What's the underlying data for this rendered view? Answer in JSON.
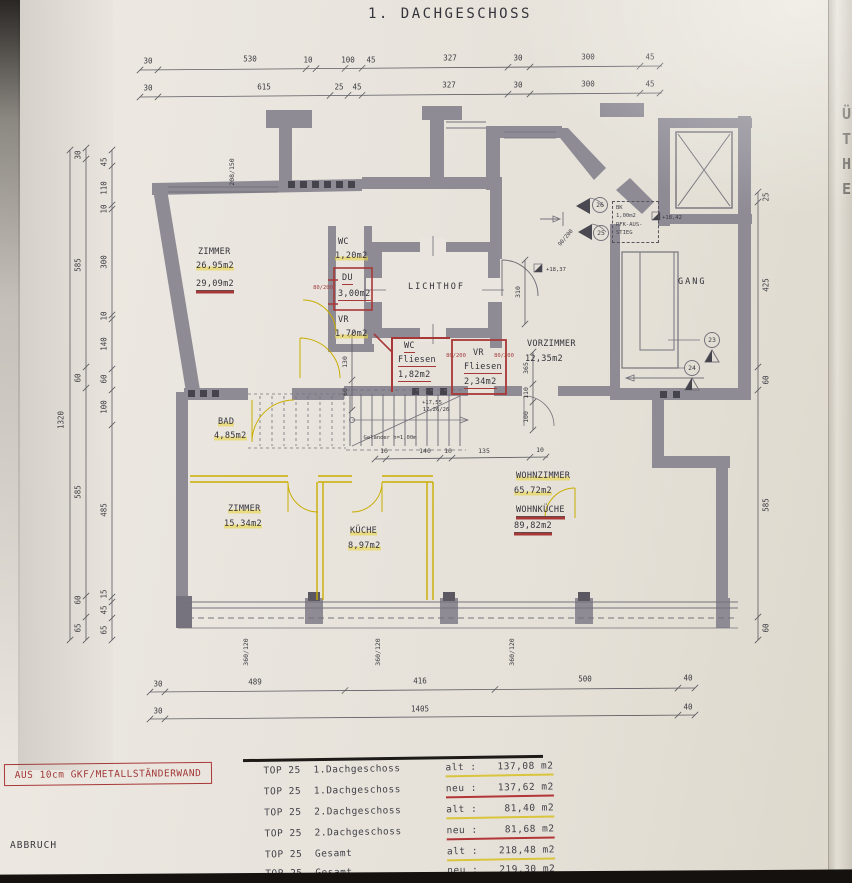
{
  "title": "1. DACHGESCHOSS",
  "edge_letters": [
    "Ü",
    "T",
    "H",
    "E"
  ],
  "legend": {
    "wall_note": "AUS 10cm GKF/METALLSTÄNDERWAND",
    "abbruch": "ABBRUCH"
  },
  "rooms": {
    "zimmer_nw": {
      "name": "ZIMMER",
      "area_old": "26,95m2",
      "area_new": "29,09m2"
    },
    "wc_nw": {
      "name": "WC",
      "area": "1,20m2"
    },
    "du": {
      "name": "DU",
      "area": "3,00m2"
    },
    "vr_nw": {
      "name": "VR",
      "area": "1,70m2"
    },
    "lichthof": {
      "name": "LICHTHOF"
    },
    "vorzimmer": {
      "name": "VORZIMMER",
      "area": "12,35m2"
    },
    "gang": {
      "name": "GANG"
    },
    "wc_mid": {
      "name": "WC",
      "finish": "Fliesen",
      "area": "1,82m2"
    },
    "vr_mid": {
      "name": "VR",
      "finish": "Fliesen",
      "area": "2,34m2"
    },
    "bad": {
      "name": "BAD",
      "area": "4,85m2"
    },
    "zimmer_sw": {
      "name": "ZIMMER",
      "area": "15,34m2"
    },
    "kueche": {
      "name": "KÜCHE",
      "area": "8,97m2"
    },
    "wohnzimmer": {
      "name": "WOHNZIMMER",
      "area": "65,72m2"
    },
    "wohnkueche": {
      "name": "WOHNKÜCHE",
      "area": "89,82m2"
    }
  },
  "annotations": {
    "gelaender": "Geländer h=1,00m",
    "stair_elev_1": "+17,55",
    "stair_elev_2": "17,26/26",
    "bk_box": [
      "BK",
      "1,00m2",
      "RFK-AUS-",
      "STIEG"
    ],
    "elev_1": "+18,42",
    "elev_2": "+18,37",
    "door_80_200": "80/200",
    "door_90_200": "90/200",
    "window_208_150": "208/150",
    "markers": {
      "m23": "23",
      "m24": "24",
      "m25": "25",
      "m26": "26"
    }
  },
  "dimensions": {
    "top1": [
      "30",
      "530",
      "10",
      "100",
      "45",
      "327",
      "30",
      "300",
      "45"
    ],
    "top2": [
      "30",
      "615",
      "25",
      "45",
      "327",
      "30",
      "300",
      "45"
    ],
    "left_total": [
      "1320"
    ],
    "left_outer": [
      "30",
      "585",
      "60",
      "585",
      "60",
      "65"
    ],
    "left_inner": [
      "45",
      "110",
      "10",
      "300",
      "10",
      "140",
      "60",
      "100",
      "485",
      "15",
      "45",
      "65"
    ],
    "right": [
      "25",
      "425",
      "60",
      "585",
      "60"
    ],
    "bottom1": [
      "30",
      "489",
      "416",
      "500",
      "40"
    ],
    "bottom2": [
      "30",
      "1405",
      "40"
    ],
    "stair": [
      "10",
      "140",
      "10",
      "135",
      "10"
    ],
    "stair_v": [
      "130",
      "60"
    ],
    "mid_v": [
      "365",
      "110",
      "100"
    ],
    "vor_v": [
      "310"
    ],
    "windows": [
      "360/120",
      "360/120",
      "360/120"
    ]
  },
  "table": {
    "rows": [
      {
        "top": "TOP 25",
        "floor": "1.Dachgeschoss",
        "kind": "alt :",
        "value": "137,08 m2"
      },
      {
        "top": "TOP 25",
        "floor": "1.Dachgeschoss",
        "kind": "neu :",
        "value": "137,62 m2"
      },
      {
        "top": "TOP 25",
        "floor": "2.Dachgeschoss",
        "kind": "alt :",
        "value": "81,40 m2"
      },
      {
        "top": "TOP 25",
        "floor": "2.Dachgeschoss",
        "kind": "neu :",
        "value": "81,68 m2"
      },
      {
        "top": "TOP 25",
        "floor": "Gesamt",
        "kind": "alt :",
        "value": "218,48 m2"
      },
      {
        "top": "TOP 25",
        "floor": "Gesamt",
        "kind": "neu :",
        "value": "219,30 m2"
      }
    ]
  },
  "colors": {
    "paper": "#e8e4dd",
    "wall": "#8e8b95",
    "line": "#5c5a62",
    "red": "#a83838",
    "yellow": "#c9ad00",
    "highlight": "#e6d34a"
  }
}
